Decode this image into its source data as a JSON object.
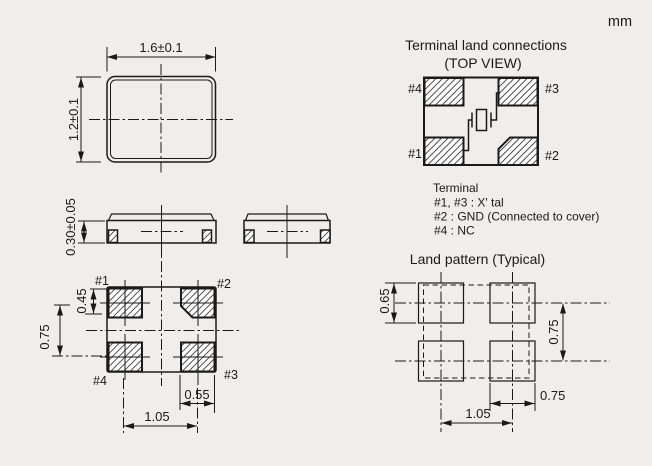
{
  "unit": "mm",
  "top_view": {
    "width_dim": "1.6±0.1",
    "height_dim": "1.2±0.1"
  },
  "side_view": {
    "thickness_dim": "0.30±0.05"
  },
  "bottom_view": {
    "pad1": "#1",
    "pad2": "#2",
    "pad3": "#3",
    "pad4": "#4",
    "pad_height_dim": "0.45",
    "row_pitch_dim": "0.75",
    "pad_width_dim": "0.55",
    "col_pitch_dim": "1.05"
  },
  "terminal_connections": {
    "title": "Terminal land connections",
    "subtitle": "(TOP VIEW)",
    "pad1": "#1",
    "pad2": "#2",
    "pad3": "#3",
    "pad4": "#4",
    "legend_title": "Terminal",
    "legend_line1": "#1, #3 : X' tal",
    "legend_line2": "#2 : GND (Connected to cover)",
    "legend_line3": "#4 : NC"
  },
  "land_pattern": {
    "title": "Land pattern (Typical)",
    "land_height_dim": "0.65",
    "row_pitch_dim": "0.75",
    "land_width_dim": "0.75",
    "col_pitch_dim": "1.05"
  },
  "colors": {
    "background": "#efeeec",
    "line": "#1a1a1a"
  }
}
